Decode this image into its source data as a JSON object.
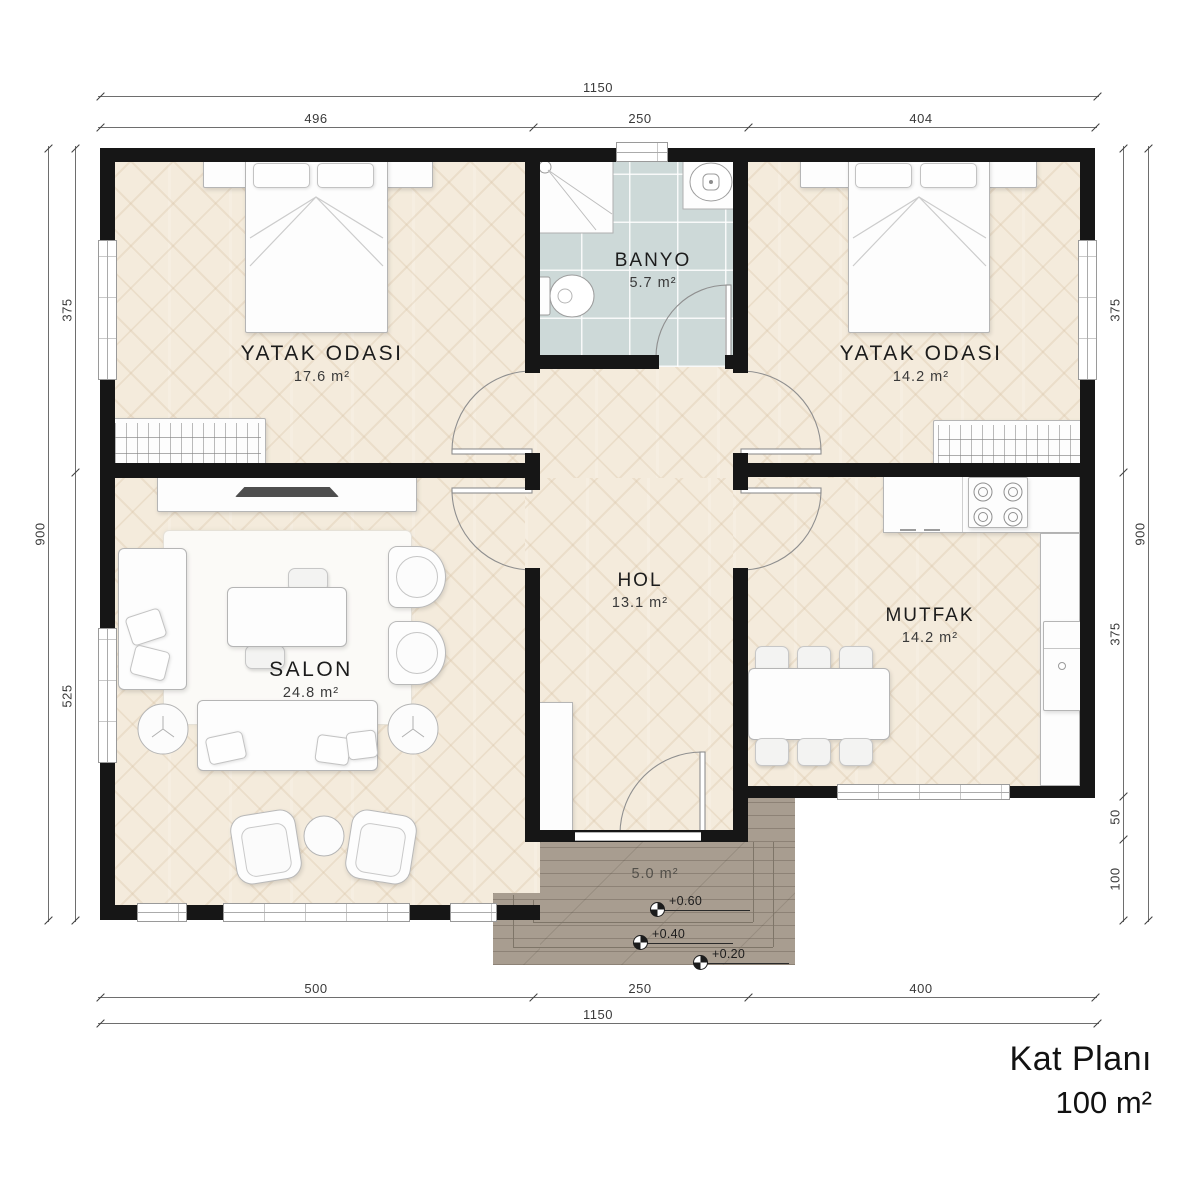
{
  "title": {
    "line1": "Kat Planı",
    "line2": "100 m²"
  },
  "rooms": {
    "bedroom_left": {
      "name": "YATAK ODASI",
      "area": "17.6 m²"
    },
    "banyo": {
      "name": "BANYO",
      "area": "5.7 m²"
    },
    "bedroom_right": {
      "name": "YATAK ODASI",
      "area": "14.2 m²"
    },
    "salon": {
      "name": "SALON",
      "area": "24.8 m²"
    },
    "hol": {
      "name": "HOL",
      "area": "13.1 m²"
    },
    "mutfak": {
      "name": "MUTFAK",
      "area": "14.2 m²"
    },
    "porch": {
      "area": "5.0 m²"
    }
  },
  "dimensions": {
    "top": {
      "overall": "1150",
      "seg1": "496",
      "seg2": "250",
      "seg3": "404"
    },
    "bottom": {
      "overall": "1150",
      "seg1": "500",
      "seg2": "250",
      "seg3": "400"
    },
    "left": {
      "overall": "900",
      "seg1": "375",
      "seg2": "525"
    },
    "right": {
      "overall": "900",
      "seg1": "375",
      "seg2": "375",
      "seg3": "50",
      "seg4": "100"
    }
  },
  "elevations": {
    "e1": "+0.60",
    "e2": "+0.40",
    "e3": "+0.20"
  },
  "colors": {
    "wall": "#161616",
    "parquet": "#f4ebdc",
    "tile": "#cdd9d8",
    "porch": "#a89d90"
  }
}
